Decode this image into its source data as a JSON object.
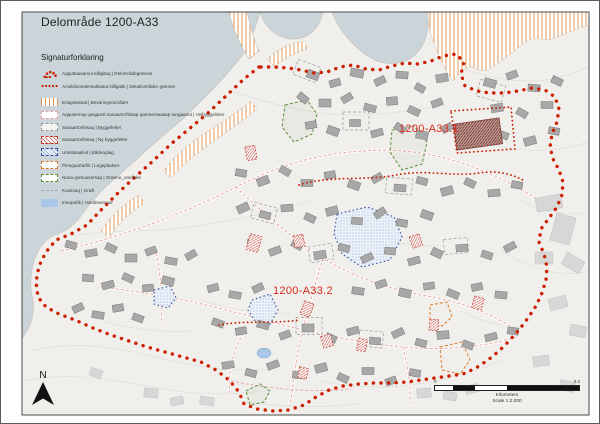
{
  "title": "Delområde 1200-A33",
  "legend": {
    "heading": "Signaturforklaring",
    "items": [
      {
        "label": "Aqquttaasamut killigitaq | Delområdegrænse"
      },
      {
        "label": "Annikitsortalersukkatut killigatik | Detailområder grænse"
      },
      {
        "label": "Eriagisassat | Bevaringsområder"
      },
      {
        "label": "Aqqusernup qeqqanit sanaartorfissap qarnnersaasap tungaanut | Vejbyggelinier"
      },
      {
        "label": "Sanaartorfissaq | Byggefelter"
      },
      {
        "label": "Sanaartorfissaq | Ny byggefelter"
      },
      {
        "label": "Umiatsaalivit | Bådeoplag"
      },
      {
        "label": "Pinnguartarfiit | Legepladser"
      },
      {
        "label": "Nuna qorsuusersaq | Grønne_områder"
      },
      {
        "label": "Kuussaq | Grøft"
      },
      {
        "label": "Imeqarfik | Vandreservoir"
      }
    ]
  },
  "map_labels": {
    "area1": "1200-A33.1",
    "area2": "1200-A33.2"
  },
  "north": {
    "label": "N"
  },
  "scale_bar": {
    "start": "0",
    "end": "0.2",
    "unit": "Kilometers",
    "scale_text": "Scale 1:2.000"
  },
  "colors": {
    "sea": "#cad4d9",
    "land": "#f0efec",
    "boundary_red": "#cc1f00",
    "building_gray": "#a8a8a8",
    "hatch_orange": "#e0985c",
    "blue": "#2d4e9e",
    "green": "#5a8f3c",
    "orange": "#e07b28",
    "pink_road": "#e8a29c",
    "water_fill": "#a9c7e6"
  }
}
